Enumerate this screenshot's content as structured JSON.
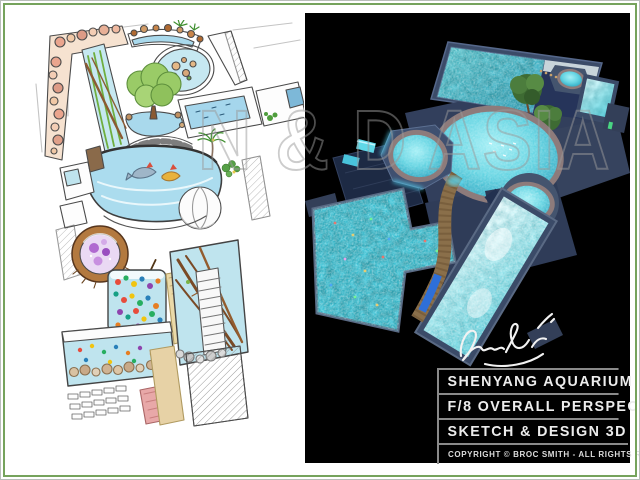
{
  "board": {
    "background": "#ffffff",
    "frame_color": "#76a35c"
  },
  "watermark": {
    "text": "N & D ASIA"
  },
  "panels": {
    "sketch": {
      "name": "aquarium-plan-sketch"
    },
    "render": {
      "name": "aquarium-3d-render",
      "background": "#000000"
    }
  },
  "signature": {
    "text": "broc Smith",
    "color": "#ffffff"
  },
  "title_block": {
    "rows": [
      "SHENYANG AQUARIUM",
      "F/8 OVERALL PERSPECTIVE",
      "SKETCH & DESIGN 3D"
    ],
    "copyright": "COPYRIGHT © BROC SMITH - ALL RIGHTS RESERVED",
    "text_color": "#ececec",
    "line_color": "#8a8a8a"
  },
  "palette": {
    "water_cyan": "#6fd8e4",
    "pool_rim": "#8d7b7b",
    "wall_slate": "#3b4b68",
    "tree_green": "#4e7d3a",
    "walkway_tan": "#9a7a4e",
    "sketch_water": "#bfe4ee",
    "rock_pink": "#eaa58e"
  }
}
